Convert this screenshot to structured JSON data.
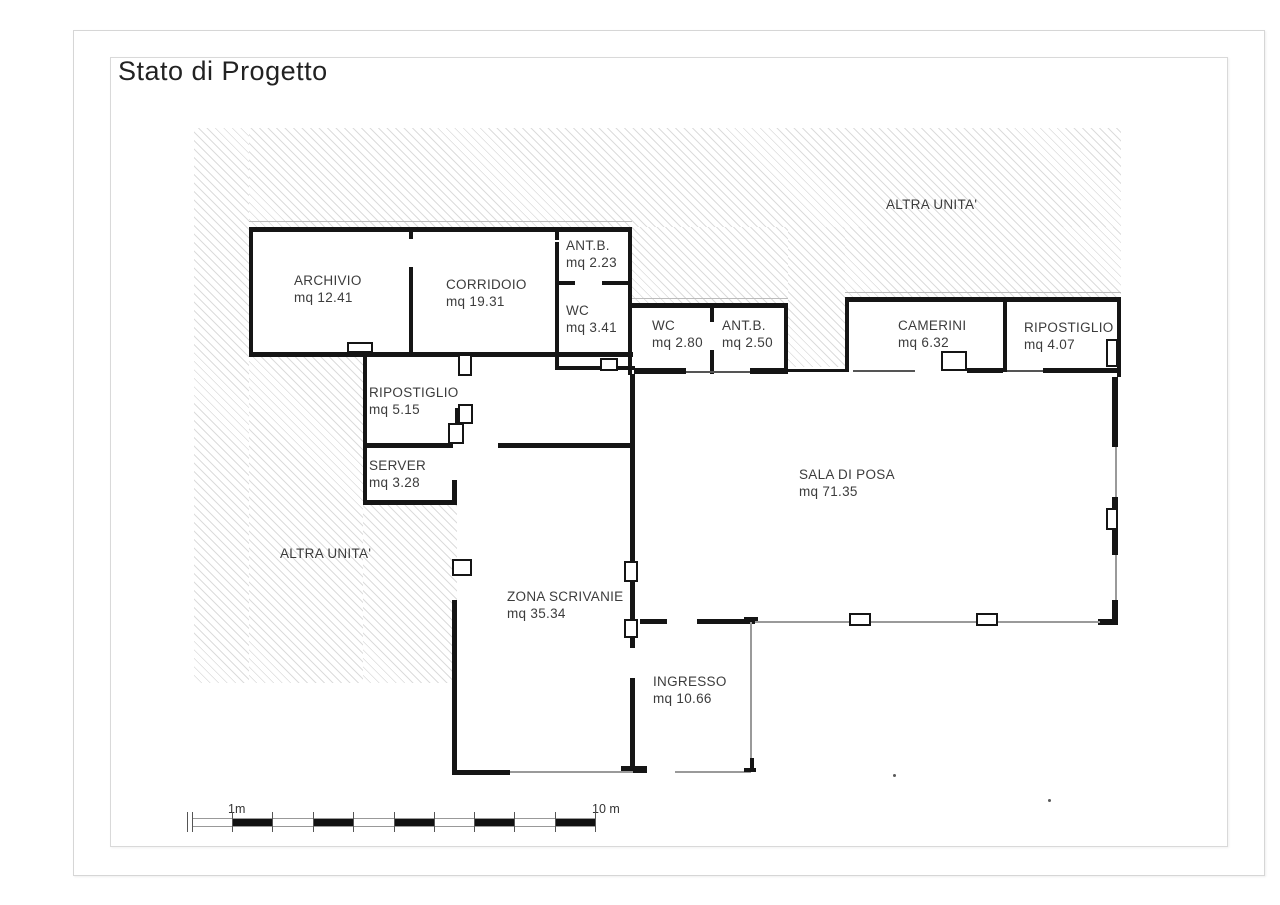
{
  "title": "Stato di Progetto",
  "plan": {
    "rooms": [
      {
        "id": "archivio",
        "name": "ARCHIVIO",
        "area": "mq 12.41"
      },
      {
        "id": "corridoio",
        "name": "CORRIDOIO",
        "area": "mq 19.31"
      },
      {
        "id": "antb-1",
        "name": "ANT.B.",
        "area": "mq 2.23"
      },
      {
        "id": "wc-1",
        "name": "WC",
        "area": "mq 3.41"
      },
      {
        "id": "wc-2",
        "name": "WC",
        "area": "mq 2.80"
      },
      {
        "id": "antb-2",
        "name": "ANT.B.",
        "area": "mq 2.50"
      },
      {
        "id": "camerini",
        "name": "CAMERINI",
        "area": "mq 6.32"
      },
      {
        "id": "ripostiglio-right",
        "name": "RIPOSTIGLIO",
        "area": "mq 4.07"
      },
      {
        "id": "ripostiglio-left",
        "name": "RIPOSTIGLIO",
        "area": "mq 5.15"
      },
      {
        "id": "server",
        "name": "SERVER",
        "area": "mq 3.28"
      },
      {
        "id": "sala-di-posa",
        "name": "SALA DI POSA",
        "area": "mq 71.35"
      },
      {
        "id": "zona-scrivanie",
        "name": "ZONA SCRIVANIE",
        "area": "mq 35.34"
      },
      {
        "id": "ingresso",
        "name": "INGRESSO",
        "area": "mq 10.66"
      }
    ],
    "other_units": [
      {
        "label": "ALTRA UNITA'"
      },
      {
        "label": "ALTRA UNITA'"
      }
    ],
    "scale": {
      "first_label": "1m",
      "last_label": "10 m"
    }
  }
}
